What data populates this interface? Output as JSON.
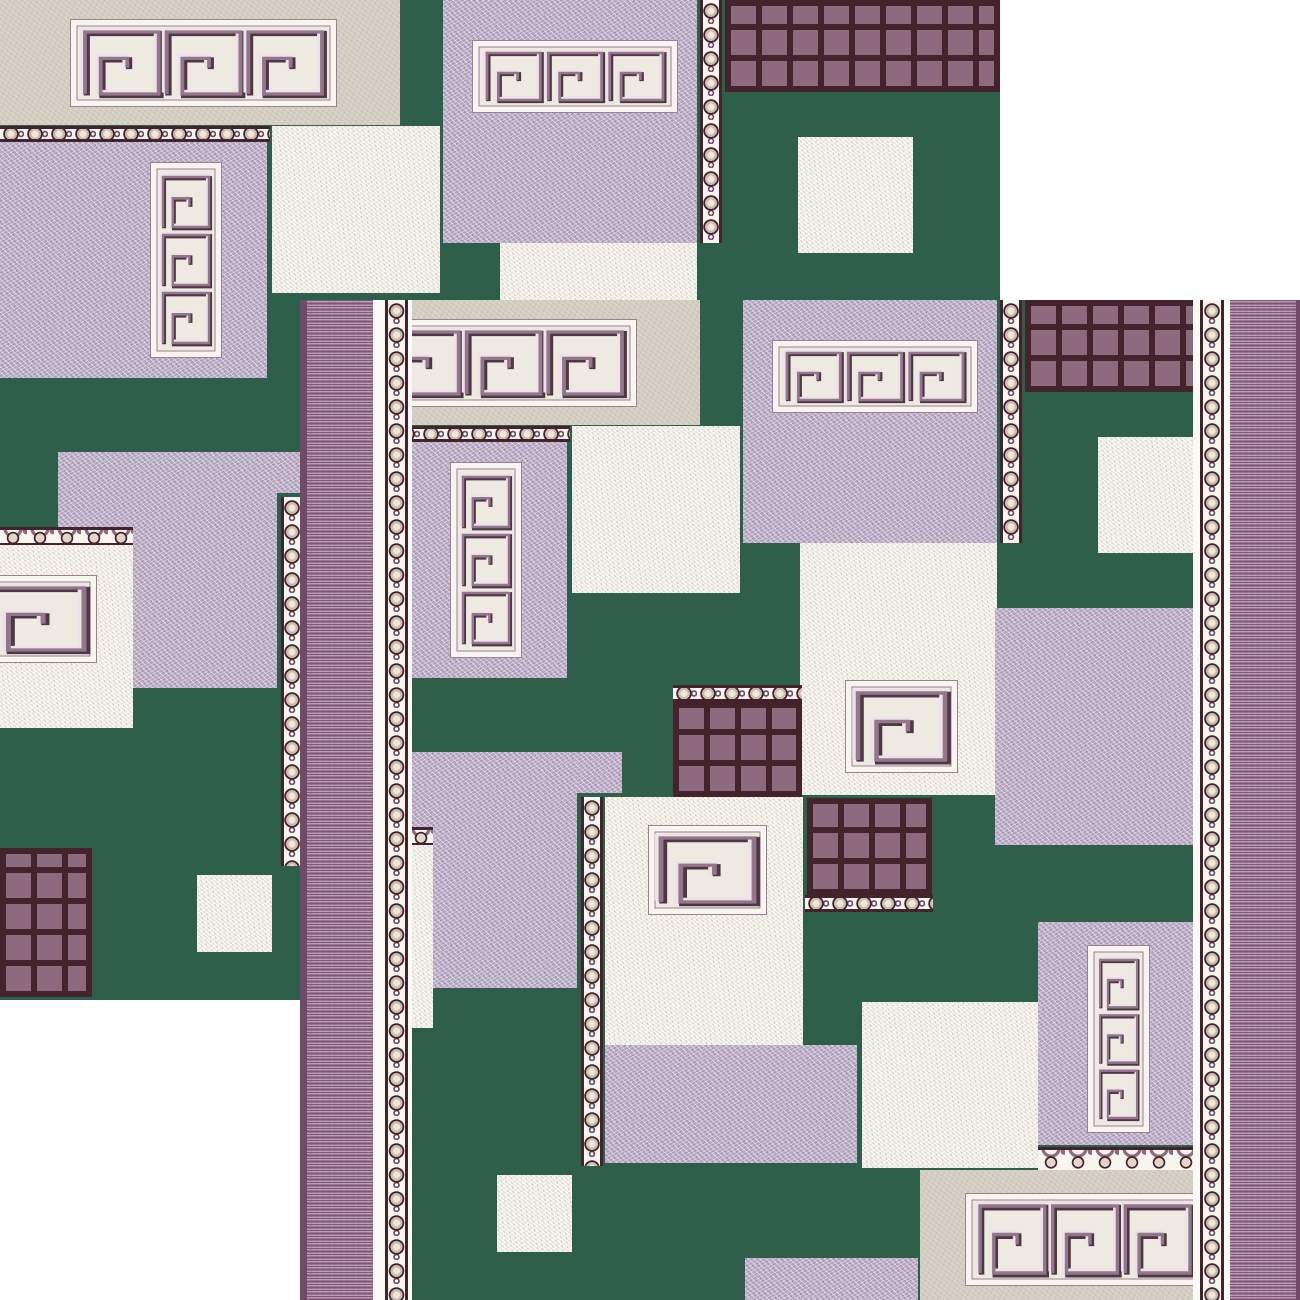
{
  "subject": "Two overlapping square pieces of a Greek-key patterned carpet runner on a white background",
  "scene": {
    "width": 1300,
    "height": 1300,
    "background": "#ffffff"
  },
  "palette": {
    "green": "#2d5f4a",
    "lavender": "#b1a1bd",
    "cream": "#e9e5db",
    "beige": "#d3ccc1",
    "white": "#f8f5f1",
    "maroon": "#44242c",
    "grid_square": "#8d6a7d",
    "bead_fill": "#d8ccbf",
    "stripe_base": "#b59cb0",
    "stripe_dash": "#7e5573",
    "stripe_edge": "#6f4b65",
    "meander_dark": "#4e3745",
    "meander_mid": "#92768b",
    "meander_light": "#ece2e8",
    "frame_line": "#9a8093",
    "frame_field": "#efeae1"
  },
  "rug_pieces": [
    {
      "name": "rug-piece-back-top-left",
      "x": 0,
      "y": 0,
      "w": 1000,
      "h": 1000,
      "has_borders": false
    },
    {
      "name": "rug-piece-front-bottom-right",
      "x": 300,
      "y": 300,
      "w": 1000,
      "h": 1000,
      "has_borders": true
    }
  ],
  "border_strips": [
    {
      "name": "stripe-band-left",
      "x": 0,
      "y": 0,
      "w": 73,
      "h": 1000,
      "fill": "stripes-l"
    },
    {
      "name": "border-gap",
      "x": 73,
      "y": 0,
      "w": 12,
      "h": 1000,
      "fill": "white"
    },
    {
      "name": "bead-border-column",
      "x": 85,
      "y": 0,
      "w": 23,
      "h": 1000,
      "fill": "bead-v"
    },
    {
      "name": "border-gap",
      "x": 108,
      "y": 0,
      "w": 4,
      "h": 1000,
      "fill": "white"
    },
    {
      "name": "border-gap",
      "x": 893,
      "y": 0,
      "w": 7,
      "h": 1000,
      "fill": "white"
    },
    {
      "name": "bead-border-column",
      "x": 900,
      "y": 0,
      "w": 24,
      "h": 1000,
      "fill": "bead-v"
    },
    {
      "name": "border-gap",
      "x": 924,
      "y": 0,
      "w": 6,
      "h": 1000,
      "fill": "white"
    },
    {
      "name": "stripe-band-right",
      "x": 930,
      "y": 0,
      "w": 70,
      "h": 1000,
      "fill": "stripes-r"
    }
  ],
  "blocks": [
    {
      "name": "beige-frieze-panel",
      "x": 0,
      "y": 0,
      "w": 400,
      "h": 125,
      "fill": "beige",
      "motif": {
        "kind": "frieze",
        "x": 70,
        "y": 19,
        "w": 267,
        "h": 88,
        "cols": 3,
        "rows": 1
      }
    },
    {
      "name": "lavender-frieze-panel",
      "x": 443,
      "y": 0,
      "w": 254,
      "h": 243,
      "fill": "lavender",
      "motif": {
        "kind": "frieze",
        "x": 29,
        "y": 40,
        "w": 206,
        "h": 73,
        "cols": 3,
        "rows": 1
      }
    },
    {
      "name": "bead-border-column",
      "x": 700,
      "y": 0,
      "w": 22,
      "h": 243,
      "fill": "bead-v"
    },
    {
      "name": "waffle-grid-panel",
      "x": 725,
      "y": 0,
      "w": 275,
      "h": 92,
      "fill": "grid"
    },
    {
      "name": "cream-square",
      "x": 798,
      "y": 137,
      "w": 115,
      "h": 116,
      "fill": "cream"
    },
    {
      "name": "bead-border-row",
      "x": 0,
      "y": 126,
      "w": 270,
      "h": 16,
      "fill": "bead-h"
    },
    {
      "name": "cream-panel",
      "x": 272,
      "y": 126,
      "w": 168,
      "h": 167,
      "fill": "cream"
    },
    {
      "name": "lavender-column-panel",
      "x": 0,
      "y": 142,
      "w": 267,
      "h": 236,
      "fill": "lavender",
      "motif": {
        "kind": "column",
        "x": 150,
        "y": 20,
        "w": 72,
        "h": 196,
        "cols": 1,
        "rows": 3
      }
    },
    {
      "name": "lavender-panel",
      "x": 58,
      "y": 452,
      "w": 219,
      "h": 236,
      "fill": "lavender"
    },
    {
      "name": "lavender-tab",
      "x": 277,
      "y": 452,
      "w": 45,
      "h": 41,
      "fill": "lavender"
    },
    {
      "name": "bead-border-column",
      "x": 281,
      "y": 497,
      "w": 22,
      "h": 369,
      "fill": "bead-v"
    },
    {
      "name": "egg-dart-row",
      "x": 0,
      "y": 527,
      "w": 133,
      "h": 18,
      "fill": "egg-h"
    },
    {
      "name": "cream-spiral-panel",
      "x": 0,
      "y": 545,
      "w": 133,
      "h": 183,
      "fill": "cream",
      "motif": {
        "kind": "spiral",
        "x": -25,
        "y": 30,
        "w": 122,
        "h": 88,
        "cols": 1,
        "rows": 1
      }
    },
    {
      "name": "waffle-grid-panel",
      "x": 0,
      "y": 848,
      "w": 92,
      "h": 149,
      "fill": "grid"
    },
    {
      "name": "cream-square",
      "x": 197,
      "y": 875,
      "w": 75,
      "h": 77,
      "fill": "cream"
    },
    {
      "name": "cream-spiral-panel",
      "x": 500,
      "y": 243,
      "w": 197,
      "h": 252,
      "fill": "cream",
      "motif": {
        "kind": "spiral",
        "x": 45,
        "y": 137,
        "w": 113,
        "h": 93,
        "cols": 1,
        "rows": 1
      }
    },
    {
      "name": "bead-border-row",
      "x": 373,
      "y": 385,
      "w": 129,
      "h": 17,
      "fill": "bead-h"
    },
    {
      "name": "waffle-grid-panel",
      "x": 373,
      "y": 402,
      "w": 129,
      "h": 95,
      "fill": "grid"
    },
    {
      "name": "cream-spiral-panel",
      "x": 305,
      "y": 497,
      "w": 198,
      "h": 248,
      "fill": "cream",
      "motif": {
        "kind": "spiral",
        "x": 43,
        "y": 28,
        "w": 119,
        "h": 90,
        "cols": 1,
        "rows": 1
      }
    },
    {
      "name": "waffle-grid-panel",
      "x": 507,
      "y": 498,
      "w": 125,
      "h": 97,
      "fill": "grid"
    },
    {
      "name": "bead-border-row",
      "x": 505,
      "y": 595,
      "w": 128,
      "h": 17,
      "fill": "bead-h"
    },
    {
      "name": "lavender-panel",
      "x": 695,
      "y": 308,
      "w": 225,
      "h": 237,
      "fill": "lavender"
    },
    {
      "name": "lavender-panel",
      "x": 305,
      "y": 745,
      "w": 252,
      "h": 118,
      "fill": "lavender"
    },
    {
      "name": "cream-panel",
      "x": 562,
      "y": 702,
      "w": 176,
      "h": 166,
      "fill": "cream"
    },
    {
      "name": "lavender-column-panel",
      "x": 738,
      "y": 622,
      "w": 155,
      "h": 223,
      "fill": "lavender",
      "motif": {
        "kind": "column",
        "x": 49,
        "y": 23,
        "w": 63,
        "h": 188,
        "cols": 1,
        "rows": 3
      }
    },
    {
      "name": "egg-dart-row",
      "x": 738,
      "y": 847,
      "w": 155,
      "h": 25,
      "fill": "egg-h"
    },
    {
      "name": "beige-frieze-panel",
      "x": 620,
      "y": 870,
      "w": 285,
      "h": 130,
      "fill": "beige",
      "motif": {
        "kind": "frieze",
        "x": 45,
        "y": 23,
        "w": 240,
        "h": 93,
        "cols": 3,
        "rows": 1
      }
    },
    {
      "name": "lavender-panel",
      "x": 445,
      "y": 958,
      "w": 173,
      "h": 42,
      "fill": "lavender"
    }
  ]
}
